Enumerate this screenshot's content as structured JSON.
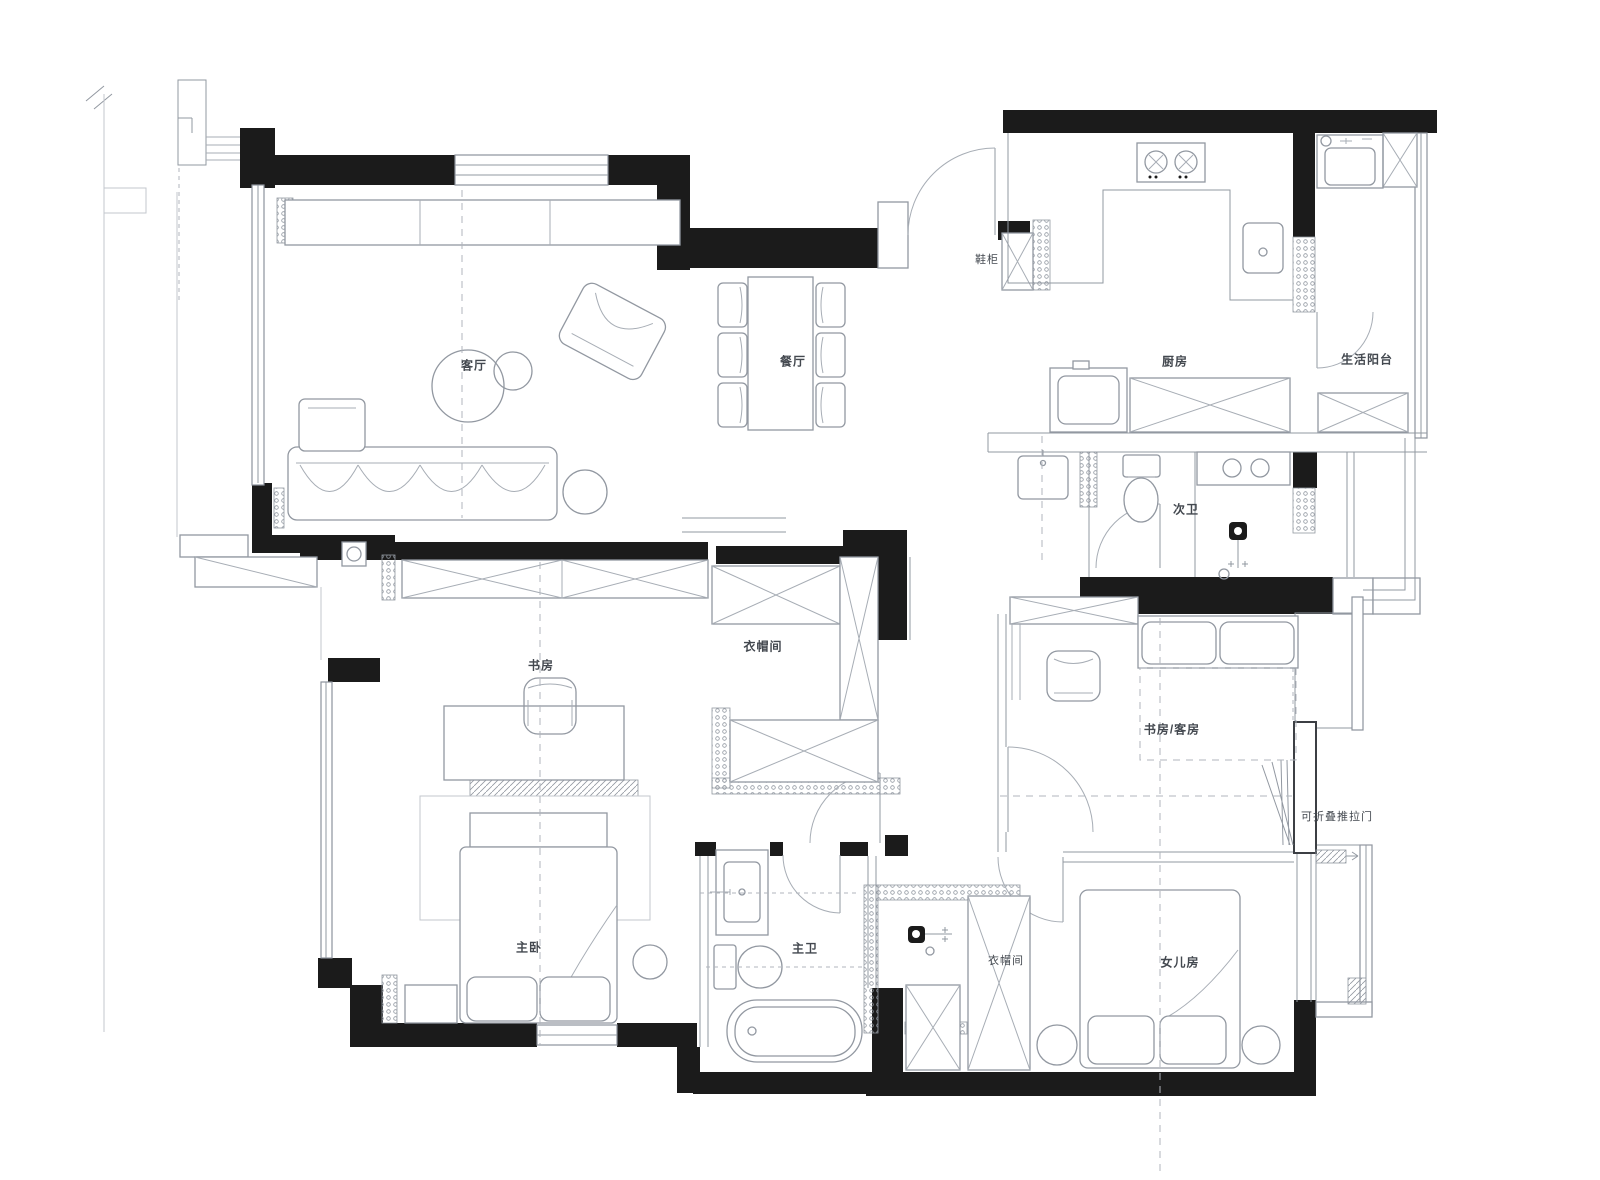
{
  "floorplan": {
    "rooms": [
      {
        "id": "living-room",
        "label": "客厅"
      },
      {
        "id": "dining-room",
        "label": "餐厅"
      },
      {
        "id": "shoe-cabinet",
        "label": "鞋柜"
      },
      {
        "id": "kitchen",
        "label": "厨房"
      },
      {
        "id": "service-balcony",
        "label": "生活阳台"
      },
      {
        "id": "second-bathroom",
        "label": "次卫"
      },
      {
        "id": "study",
        "label": "书房"
      },
      {
        "id": "walk-in-closet",
        "label": "衣帽间"
      },
      {
        "id": "study-guest-room",
        "label": "书房/客房"
      },
      {
        "id": "folding-sliding-door",
        "label": "可折叠推拉门"
      },
      {
        "id": "master-bedroom",
        "label": "主卧"
      },
      {
        "id": "master-bathroom",
        "label": "主卫"
      },
      {
        "id": "closet-2",
        "label": "衣帽间"
      },
      {
        "id": "daughter-room",
        "label": "女儿房"
      }
    ],
    "colors": {
      "wall": "#1b1b1b",
      "furniture_line": "#9298a1",
      "dash_line": "#b0b5bc",
      "text": "#43484f"
    }
  }
}
